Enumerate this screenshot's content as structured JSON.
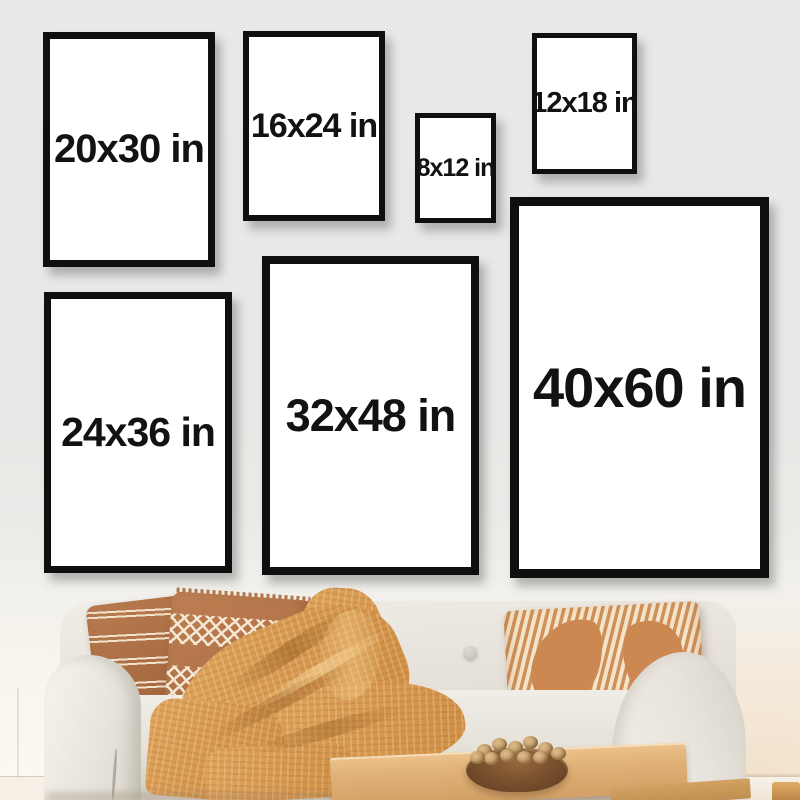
{
  "page": {
    "type": "poster-size-comparison-photo",
    "description_text": ""
  },
  "frames": [
    {
      "size_in": {
        "w": 20,
        "h": 30
      },
      "label": "20x30 in"
    },
    {
      "size_in": {
        "w": 16,
        "h": 24
      },
      "label": "16x24 in"
    },
    {
      "size_in": {
        "w": 8,
        "h": 12
      },
      "label": "8x12 in"
    },
    {
      "size_in": {
        "w": 12,
        "h": 18
      },
      "label": "12x18 in"
    },
    {
      "size_in": {
        "w": 24,
        "h": 36
      },
      "label": "24x36 in"
    },
    {
      "size_in": {
        "w": 32,
        "h": 48
      },
      "label": "32x48 in"
    },
    {
      "size_in": {
        "w": 40,
        "h": 60
      },
      "label": "40x60 in"
    }
  ],
  "colors": {
    "frame_border": "#0f0f0f",
    "frame_face": "#ffffff",
    "label_text": "#121212",
    "wall_top": "#e8e8e6",
    "wall_bottom": "#f8f1e7",
    "sofa_fabric": "#e8e4dd",
    "pillow_rust": "#a9714a",
    "pillow_cream": "#f2e3cd",
    "throw_mustard": "#d89a52",
    "table_wood": "#dfb077",
    "bowl_wood": "#7c5330"
  }
}
